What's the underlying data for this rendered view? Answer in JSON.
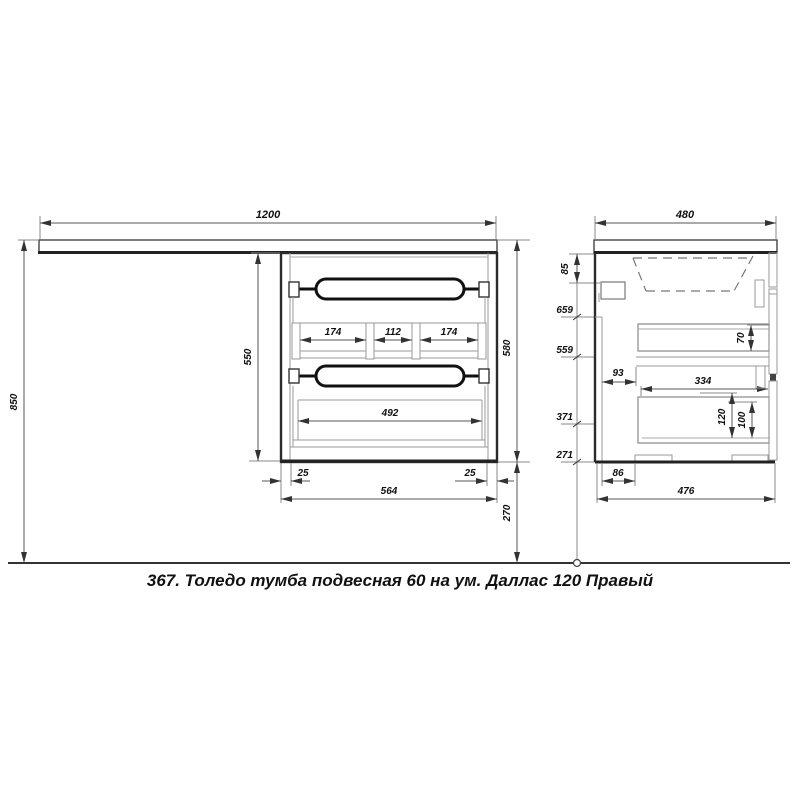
{
  "page": {
    "caption": "367. Толедо тумба подвесная 60 на ум. Даллас 120 Правый"
  },
  "front_view": {
    "countertop_width": "1200",
    "overall_height": "850",
    "carcass_height": "550",
    "cabinet_height": "580",
    "floor_clearance": "270",
    "organizer_left": "174",
    "organizer_center": "112",
    "organizer_right": "174",
    "drawer_inner_width": "492",
    "panel_inset_left": "25",
    "panel_inset_right": "25",
    "cabinet_width": "564"
  },
  "side_view": {
    "countertop_depth": "480",
    "basin_depth": "85",
    "level_top": "659",
    "level_upper": "559",
    "level_mid": "371",
    "level_bottom": "271",
    "back_gap": "93",
    "upper_drawer_side_height": "70",
    "drawer_depth": "334",
    "lower_drawer_inner_height": "120",
    "lower_drawer_box_height": "100",
    "bottom_back_inset": "86",
    "cabinet_depth": "476"
  }
}
